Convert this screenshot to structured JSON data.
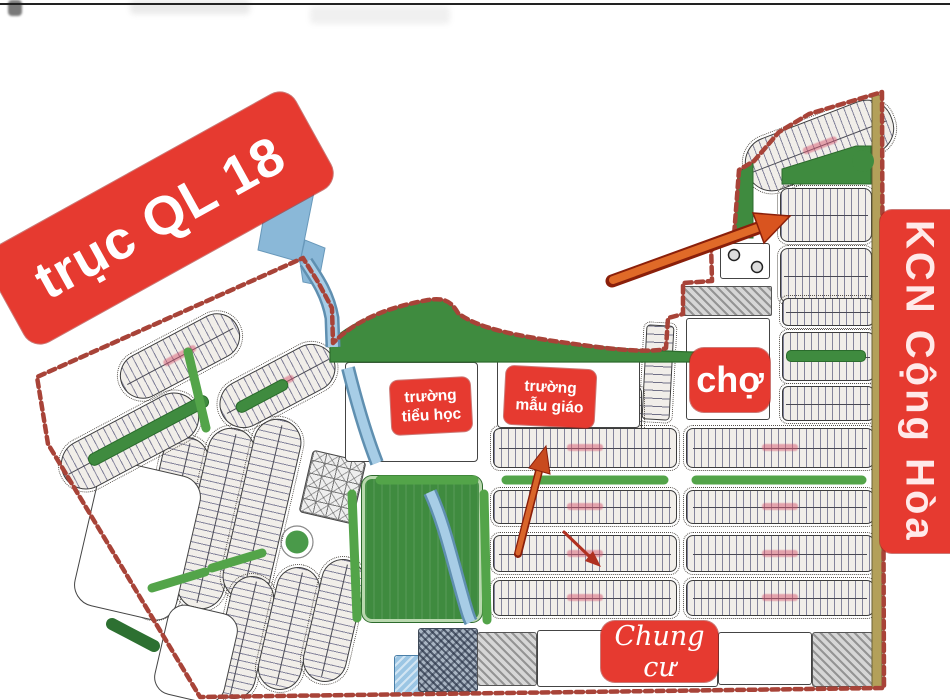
{
  "labels": {
    "road_axis": "trục QL 18",
    "industrial_zone": "KCN Cộng Hòa",
    "market": "chợ",
    "primary_school": {
      "line1": "trường",
      "line2": "tiểu học"
    },
    "kindergarten": {
      "line1": "trường",
      "line2": "mẫu giáo"
    },
    "apartments": "Chung cư"
  },
  "icons": {
    "highlight_arrow_large": "➔",
    "highlight_arrow_center": "➔",
    "highlight_arrow_small": "➔"
  },
  "colors": {
    "banner_red": "#e63a30",
    "banner_text": "#ffffff",
    "boundary_red": "#a84338",
    "park_green": "#3f8b3f",
    "median_green": "#53a449",
    "dark_green": "#2d7031",
    "water_blue": "#9cc6e4",
    "water_edge": "#5f8fb0",
    "arrow_orange": "#e06a28",
    "arrow_dark_red": "#b8331f",
    "tan_strip": "#b3a05a"
  }
}
